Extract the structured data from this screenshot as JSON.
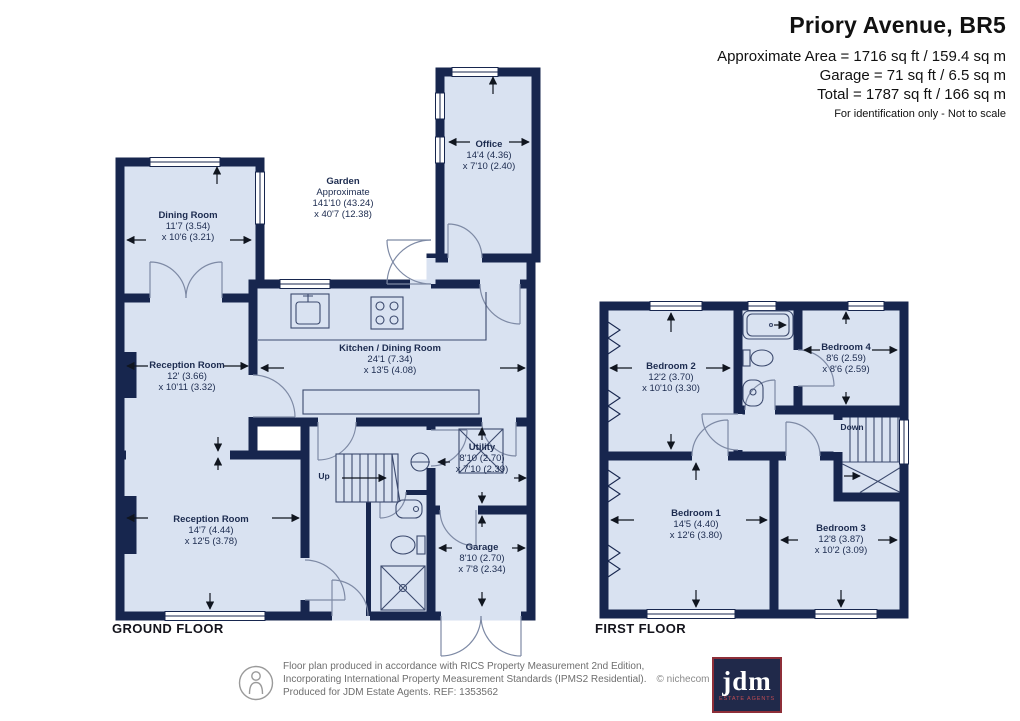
{
  "header": {
    "title": "Priory Avenue, BR5",
    "area_line": "Approximate Area = 1716 sq ft / 159.4 sq m",
    "garage_line": "Garage = 71 sq ft / 6.5 sq m",
    "total_line": "Total = 1787 sq ft / 166 sq m",
    "note": "For identification only - Not to scale"
  },
  "ground": {
    "label": "GROUND FLOOR",
    "stairs_label": "Up",
    "rooms": {
      "garden": {
        "name": "Garden",
        "sub": "Approximate",
        "dim1": "141'10 (43.24)",
        "dim2": "x 40'7 (12.38)"
      },
      "office": {
        "name": "Office",
        "dim1": "14'4 (4.36)",
        "dim2": "x 7'10 (2.40)"
      },
      "dining": {
        "name": "Dining Room",
        "dim1": "11'7 (3.54)",
        "dim2": "x 10'6 (3.21)"
      },
      "kitchen": {
        "name": "Kitchen / Dining Room",
        "dim1": "24'1 (7.34)",
        "dim2": "x 13'5 (4.08)"
      },
      "reception1": {
        "name": "Reception Room",
        "dim1": "12' (3.66)",
        "dim2": "x 10'11 (3.32)"
      },
      "reception2": {
        "name": "Reception Room",
        "dim1": "14'7 (4.44)",
        "dim2": "x 12'5 (3.78)"
      },
      "utility": {
        "name": "Utility",
        "dim1": "8'10 (2.70)",
        "dim2": "x 7'10 (2.39)"
      },
      "garage": {
        "name": "Garage",
        "dim1": "8'10 (2.70)",
        "dim2": "x 7'8 (2.34)"
      }
    }
  },
  "first": {
    "label": "FIRST FLOOR",
    "stairs_label": "Down",
    "rooms": {
      "bedroom1": {
        "name": "Bedroom 1",
        "dim1": "14'5 (4.40)",
        "dim2": "x 12'6 (3.80)"
      },
      "bedroom2": {
        "name": "Bedroom 2",
        "dim1": "12'2 (3.70)",
        "dim2": "x 10'10 (3.30)"
      },
      "bedroom3": {
        "name": "Bedroom 3",
        "dim1": "12'8 (3.87)",
        "dim2": "x 10'2 (3.09)"
      },
      "bedroom4": {
        "name": "Bedroom 4",
        "dim1": "8'6 (2.59)",
        "dim2": "x 8'6 (2.59)"
      }
    }
  },
  "footer": {
    "line1": "Floor plan produced in accordance with RICS Property Measurement 2nd Edition,",
    "line2": "Incorporating International Property Measurement Standards (IPMS2 Residential).",
    "copyright": "© nichecom 2025.",
    "line3": "Produced for JDM Estate Agents.   REF: 1353562",
    "logo_mark": "jdm",
    "logo_tagline": "ESTATE AGENTS"
  },
  "colors": {
    "wall": "#17264e",
    "floor": "#d9e2f1",
    "logo_red": "#8e2f39"
  }
}
